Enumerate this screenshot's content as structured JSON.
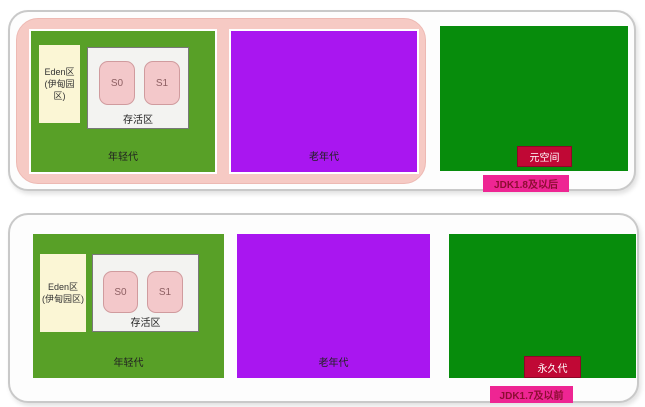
{
  "diagram": {
    "title": "JVM heap memory structure comparison",
    "panels": [
      {
        "id": "jdk8",
        "jdk_badge": "JDK1.8及以后",
        "heap_wrapper_present": true,
        "young": {
          "label": "年轻代",
          "eden_label": "Eden区(伊甸园区)",
          "survivor": {
            "label": "存活区",
            "s0": "S0",
            "s1": "S1"
          }
        },
        "old_label": "老年代",
        "method_area": "元空间"
      },
      {
        "id": "jdk7",
        "jdk_badge": "JDK1.7及以前",
        "heap_wrapper_present": false,
        "young": {
          "label": "年轻代",
          "eden_label": "Eden区(伊甸园区)",
          "survivor": {
            "label": "存活区",
            "s0": "S0",
            "s1": "S1"
          }
        },
        "old_label": "老年代",
        "method_area": "永久代"
      }
    ],
    "colors": {
      "young_gen_green": "#58a027",
      "old_gen_purple": "#a916f0",
      "method_area_green": "#078c0c",
      "heap_wrapper_pink": "#f6cac4",
      "eden_cream": "#fbf6d5",
      "survivor_gray": "#f3f3f1",
      "survivor_slot_pink": "#f3c8ca",
      "method_area_badge_red": "#c00835",
      "jdk_badge_pink": "#ee2593",
      "panel_border_gray": "#c9c9c9"
    }
  }
}
